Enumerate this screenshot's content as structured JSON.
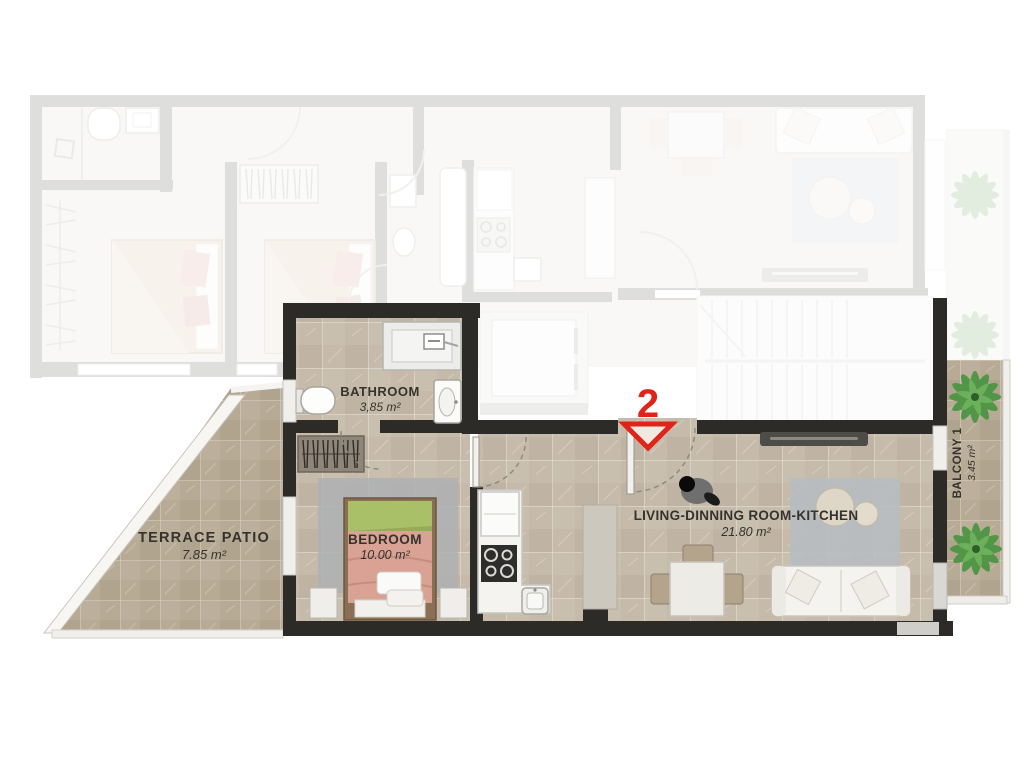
{
  "unit": {
    "number": "2"
  },
  "rooms": {
    "bathroom": {
      "name": "BATHROOM",
      "area": "3,85 m²"
    },
    "bedroom": {
      "name": "BEDROOM",
      "area": "10.00 m²"
    },
    "terrace": {
      "name": "TERRACE  PATIO",
      "area": "7.85 m²"
    },
    "living": {
      "name": "LIVING-DINNING ROOM-KITCHEN",
      "area": "21.80 m²"
    },
    "balcony": {
      "name": "BALCONY 1",
      "area": "3.45 m²"
    }
  },
  "colors": {
    "accent_red": "#e02419",
    "active_wall": "#2d2b28",
    "active_floor": "#c6bbaa",
    "terrace_floor": "#b8ab96",
    "faded_wall": "#9b9b99",
    "rug_gray": "#b7bcc1",
    "bed_green": "#a9c068",
    "bed_pink": "#d9a294",
    "plant_green": "#4a9441"
  }
}
